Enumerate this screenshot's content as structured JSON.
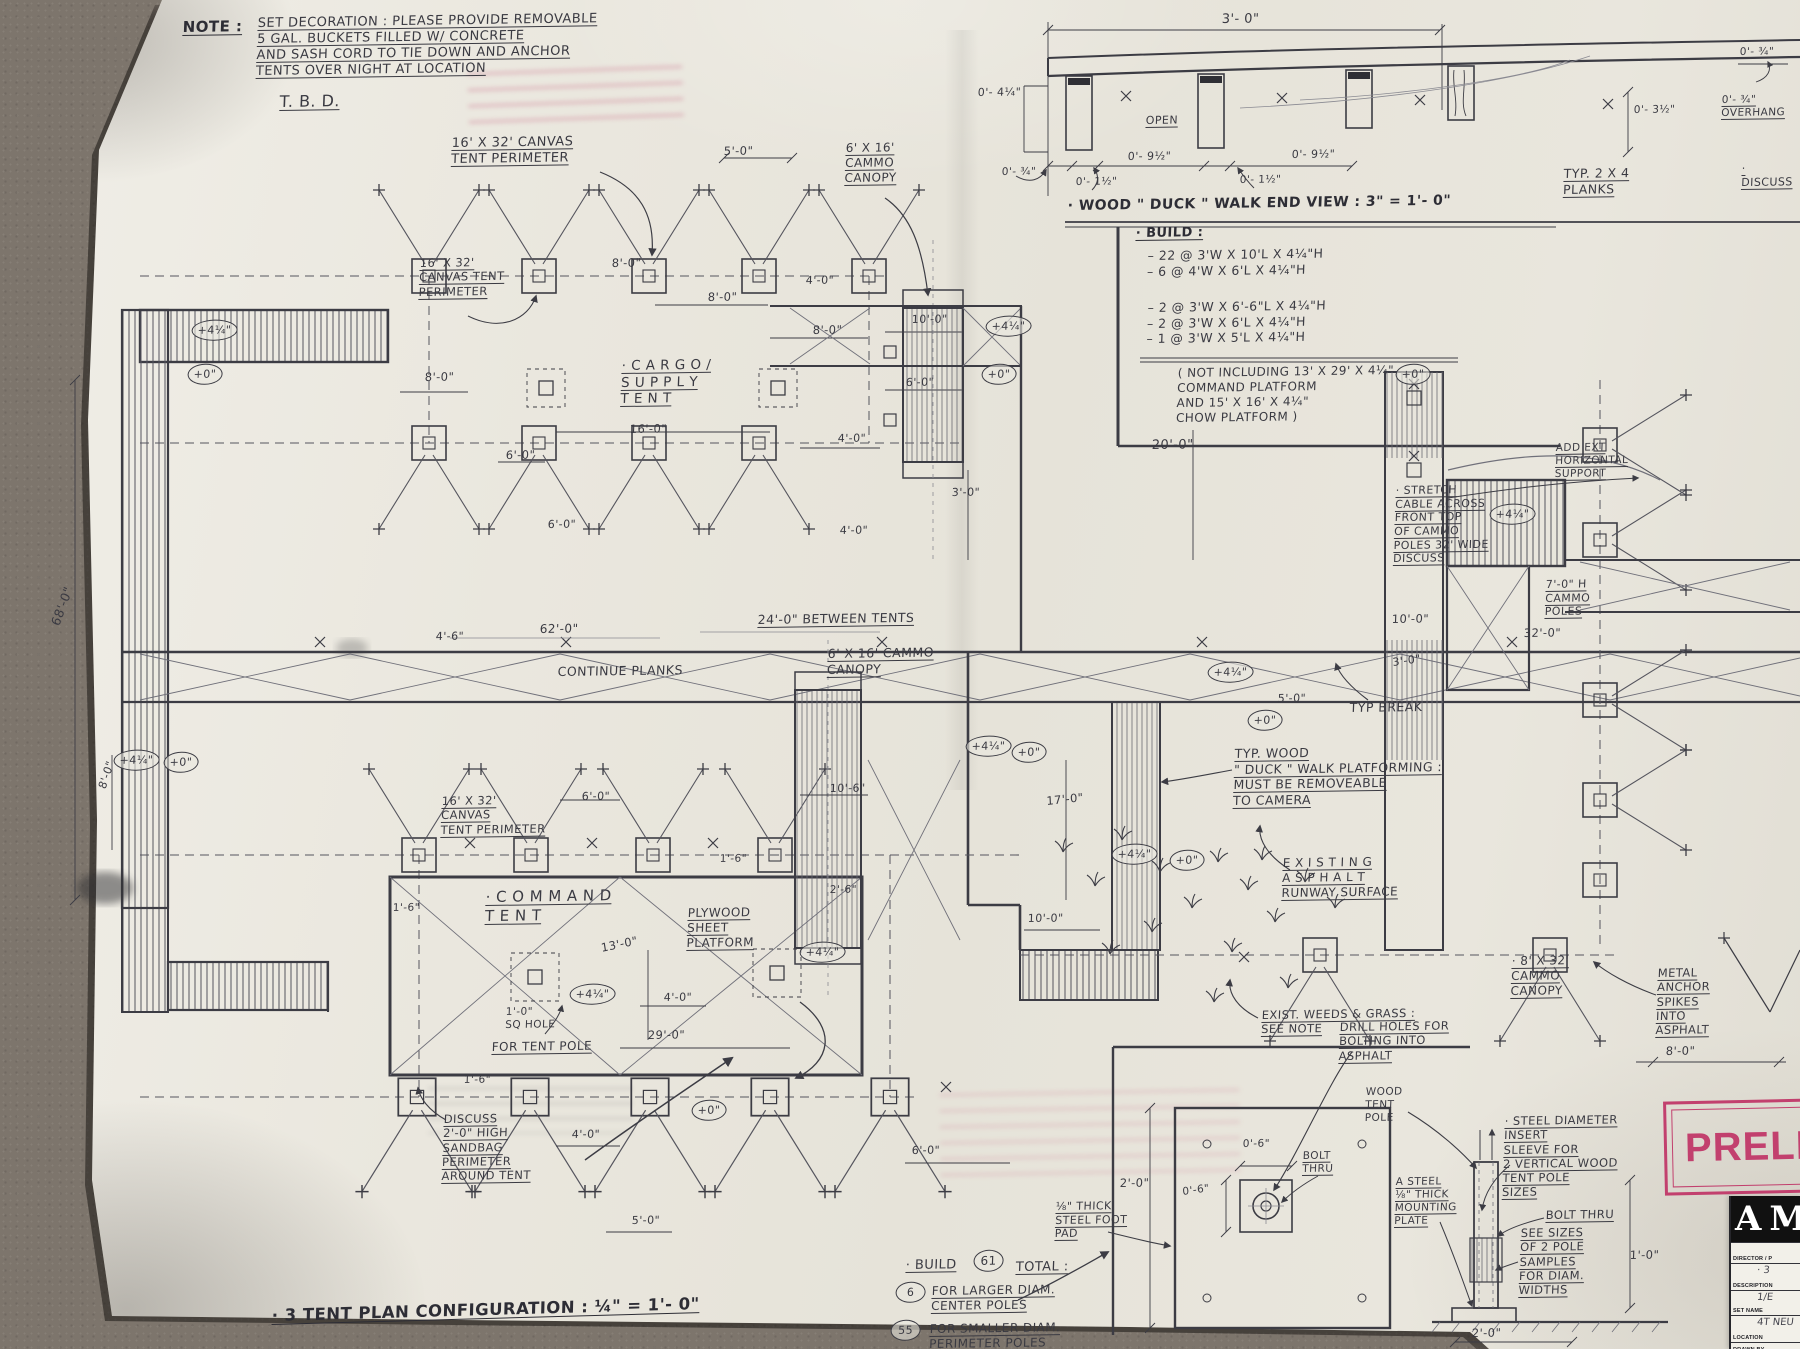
{
  "stamp": {
    "text": "PRELIM",
    "color": "#c2406e"
  },
  "title_block": {
    "logo": "AM",
    "rows": [
      {
        "label": "DIRECTOR / P",
        "value": ""
      },
      {
        "label": "DESCRIPTION",
        "value": "· 3"
      },
      {
        "label": "SET NAME",
        "value": "1/E"
      },
      {
        "label": "LOCATION",
        "value": "4T NEU"
      },
      {
        "label": "DRAWN BY",
        "value": ""
      }
    ]
  },
  "annotations": [
    {
      "n": "note-heading",
      "t": "NOTE :",
      "x": 183,
      "y": 18,
      "s": 15,
      "u": 1,
      "b": 1
    },
    {
      "n": "note-body",
      "t": "SET DECORATION : PLEASE PROVIDE REMOVABLE\n5 GAL. BUCKETS FILLED W/ CONCRETE\nAND SASH CORD TO TIE DOWN AND ANCHOR\nTENTS OVER NIGHT AT LOCATION",
      "x": 258,
      "y": 16,
      "s": 13,
      "u": 1,
      "w": 345
    },
    {
      "n": "note-tbd",
      "t": "T. B. D.",
      "x": 280,
      "y": 92,
      "s": 16,
      "u": 1
    },
    {
      "n": "label-tent-perimeter-upper",
      "t": "16' X 32' CANVAS\nTENT PERIMETER",
      "x": 452,
      "y": 136,
      "s": 13,
      "u": 1
    },
    {
      "n": "dim-5ft-upper",
      "t": "5'-0\"",
      "x": 724,
      "y": 144,
      "s": 11.5
    },
    {
      "n": "label-cammo-canopy-upper",
      "t": "6' X 16'\nCAMMO\nCANOPY",
      "x": 846,
      "y": 141,
      "s": 12,
      "u": 1
    },
    {
      "n": "label-tent-perimeter-note-upper",
      "t": "16' X 32'\nCANVAS TENT\nPERIMETER",
      "x": 420,
      "y": 256,
      "s": 11.5,
      "u": 1
    },
    {
      "n": "dim",
      "t": "8'-0\"",
      "x": 612,
      "y": 256,
      "s": 11.5
    },
    {
      "n": "dim",
      "t": "8'-0\"",
      "x": 708,
      "y": 290,
      "s": 11.5
    },
    {
      "n": "dim",
      "t": "4'-0\"",
      "x": 806,
      "y": 274,
      "s": 11
    },
    {
      "n": "dim",
      "t": "8'-0\"",
      "x": 813,
      "y": 323,
      "s": 11.5
    },
    {
      "n": "dim",
      "t": "10'-0\"",
      "x": 912,
      "y": 313,
      "s": 11
    },
    {
      "n": "dim",
      "t": "6'-0\"",
      "x": 906,
      "y": 376,
      "s": 11
    },
    {
      "n": "dim",
      "t": "4'-0\"",
      "x": 838,
      "y": 432,
      "s": 11
    },
    {
      "n": "label-cargo-tent",
      "t": "· C A R G O /\nS U P P L Y\nT E N T",
      "x": 622,
      "y": 358,
      "s": 13.5,
      "u": 1
    },
    {
      "n": "dim",
      "t": "16'-0\"",
      "x": 630,
      "y": 422,
      "s": 11.5
    },
    {
      "n": "dim",
      "t": "8'-0\"",
      "x": 425,
      "y": 370,
      "s": 11.5
    },
    {
      "n": "dim",
      "t": "6'-0\"",
      "x": 506,
      "y": 448,
      "s": 11.5
    },
    {
      "n": "dim",
      "t": "3'-0\"",
      "x": 952,
      "y": 486,
      "s": 11
    },
    {
      "n": "dim-20ft",
      "t": "20'-0\"",
      "x": 1152,
      "y": 438,
      "s": 13
    },
    {
      "n": "label-between-tents",
      "t": "24'-0\" BETWEEN TENTS",
      "x": 758,
      "y": 612,
      "s": 12.5,
      "u": 1
    },
    {
      "n": "label-continue-planks",
      "t": "CONTINUE  PLANKS",
      "x": 558,
      "y": 664,
      "s": 12.5
    },
    {
      "n": "dim",
      "t": "62'-0\"",
      "x": 540,
      "y": 622,
      "s": 12
    },
    {
      "n": "dim",
      "t": "4'-6\"",
      "x": 436,
      "y": 630,
      "s": 11
    },
    {
      "n": "dim-68ft",
      "t": "68'-0\"",
      "x": 48,
      "y": 622,
      "s": 12.5,
      "r": -70
    },
    {
      "n": "dim",
      "t": "6'-0\"",
      "x": 548,
      "y": 518,
      "s": 11
    },
    {
      "n": "dim",
      "t": "4'-0\"",
      "x": 840,
      "y": 524,
      "s": 11
    },
    {
      "n": "dim",
      "t": "8'-0\"",
      "x": 96,
      "y": 786,
      "s": 11,
      "r": -72
    },
    {
      "n": "label-stretch-cable",
      "t": "· STRETCH\nCABLE ACROSS\nFRONT TOP\nOF CAMMO\nPOLES 32' WIDE\nDISCUSS",
      "x": 1396,
      "y": 484,
      "s": 11,
      "u": 1,
      "w": 108
    },
    {
      "n": "label-cammo-poles",
      "t": "7'-0\" H\nCAMMO\nPOLES",
      "x": 1546,
      "y": 578,
      "s": 11,
      "u": 1
    },
    {
      "n": "dim",
      "t": "32'-0\"",
      "x": 1524,
      "y": 626,
      "s": 11.5
    },
    {
      "n": "dim",
      "t": "10'-0\"",
      "x": 1392,
      "y": 612,
      "s": 11.5
    },
    {
      "n": "dim",
      "t": "3'-0\"",
      "x": 1392,
      "y": 656,
      "s": 11,
      "r": -8
    },
    {
      "n": "label-typ-break",
      "t": "TYP  BREAK",
      "x": 1350,
      "y": 700,
      "s": 12.5
    },
    {
      "n": "label-duck-walk-typ",
      "t": "TYP. WOOD\n\" DUCK \" WALK  PLATFORMING :\nMUST  BE  REMOVEABLE\nTO CAMERA",
      "x": 1235,
      "y": 746,
      "s": 12.5,
      "u": 1,
      "w": 235
    },
    {
      "n": "dim",
      "t": "17'-0\"",
      "x": 1046,
      "y": 794,
      "s": 11.5,
      "r": -6
    },
    {
      "n": "label-existing-asphalt",
      "t": "E X I S T I N G\nA S P H A L T\nRUNWAY  SURFACE",
      "x": 1283,
      "y": 856,
      "s": 12,
      "u": 1
    },
    {
      "n": "label-exist-weeds",
      "t": "EXIST. WEEDS & GRASS :\nSEE  NOTE",
      "x": 1262,
      "y": 1008,
      "s": 11.5,
      "u": 1
    },
    {
      "n": "dim",
      "t": "10'-0\"",
      "x": 1028,
      "y": 912,
      "s": 11
    },
    {
      "n": "dim",
      "t": "5'-0\"",
      "x": 1278,
      "y": 692,
      "s": 11
    },
    {
      "n": "label-tent-perimeter-lower",
      "t": "16' X 32'\nCANVAS\nTENT PERIMETER",
      "x": 442,
      "y": 794,
      "s": 11.5,
      "u": 1
    },
    {
      "n": "dim",
      "t": "6'-0\"",
      "x": 582,
      "y": 790,
      "s": 11
    },
    {
      "n": "dim",
      "t": "10'-6\"",
      "x": 830,
      "y": 782,
      "s": 11
    },
    {
      "n": "dim",
      "t": "1'-6\"",
      "x": 720,
      "y": 853,
      "s": 10.5
    },
    {
      "n": "dim",
      "t": "2'-6\"",
      "x": 830,
      "y": 884,
      "s": 10.5
    },
    {
      "n": "dim",
      "t": "1'-6\"",
      "x": 393,
      "y": 902,
      "s": 10.5
    },
    {
      "n": "label-command-tent",
      "t": "· C O M M A N D\nT E N T",
      "x": 486,
      "y": 888,
      "s": 15,
      "u": 1
    },
    {
      "n": "label-plywood-platform",
      "t": "PLYWOOD\nSHEET\nPLATFORM",
      "x": 688,
      "y": 906,
      "s": 12,
      "u": 1
    },
    {
      "n": "dim",
      "t": "13'-0\"",
      "x": 600,
      "y": 941,
      "s": 11.5,
      "r": -12
    },
    {
      "n": "dim",
      "t": "4'-0\"",
      "x": 664,
      "y": 991,
      "s": 11
    },
    {
      "n": "label-sq-hole",
      "t": "1'-0\"\nSQ  HOLE",
      "x": 506,
      "y": 1006,
      "s": 10.5
    },
    {
      "n": "label-for-tent-pole",
      "t": "FOR  TENT POLE",
      "x": 492,
      "y": 1040,
      "s": 12,
      "u": 1
    },
    {
      "n": "dim",
      "t": "29'-0\"",
      "x": 648,
      "y": 1028,
      "s": 11.5
    },
    {
      "n": "dim",
      "t": "1'-6\"",
      "x": 464,
      "y": 1074,
      "s": 10.5
    },
    {
      "n": "label-sandbag",
      "t": "DISCUSS\n2'-0\" HIGH\nSANDBAG\nPERIMETER\nAROUND TENT",
      "x": 444,
      "y": 1112,
      "s": 11.5,
      "u": 1
    },
    {
      "n": "dim",
      "t": "4'-0\"",
      "x": 572,
      "y": 1128,
      "s": 11
    },
    {
      "n": "dim",
      "t": "5'-0\"",
      "x": 632,
      "y": 1214,
      "s": 11
    },
    {
      "n": "sheet-title",
      "t": "· 3  TENT  PLAN  CONFIGURATION :  ¼\" = 1'- 0\"",
      "x": 272,
      "y": 1306,
      "s": 16.5,
      "u": 1,
      "r": -1.6,
      "b": 1
    },
    {
      "n": "label-build-total",
      "t": "· BUILD",
      "x": 906,
      "y": 1258,
      "s": 13,
      "u": 1
    },
    {
      "n": "circ-61",
      "t": "61",
      "x": 974,
      "y": 1250,
      "c": 1,
      "s": 12
    },
    {
      "n": "label-total",
      "t": "TOTAL :",
      "x": 1016,
      "y": 1260,
      "s": 13,
      "u": 1
    },
    {
      "n": "circ-6",
      "t": "6",
      "x": 896,
      "y": 1282,
      "c": 1,
      "s": 11
    },
    {
      "n": "label-center-poles",
      "t": "FOR LARGER DIAM.\nCENTER  POLES",
      "x": 932,
      "y": 1284,
      "s": 12,
      "u": 1
    },
    {
      "n": "circ-55",
      "t": "55",
      "x": 891,
      "y": 1320,
      "c": 1,
      "s": 11
    },
    {
      "n": "label-perimeter-poles",
      "t": "FOR SMALLER DIAM.\nPERIMETER POLES",
      "x": 930,
      "y": 1322,
      "s": 12,
      "u": 1
    },
    {
      "n": "dim",
      "t": "6'-0\"",
      "x": 912,
      "y": 1144,
      "s": 11
    },
    {
      "n": "dim",
      "t": "2'-0\"",
      "x": 1120,
      "y": 1176,
      "s": 11.5
    },
    {
      "n": "label-drill-holes",
      "t": "DRILL HOLES FOR\nBOLTING INTO\nASPHALT",
      "x": 1340,
      "y": 1020,
      "s": 11.5,
      "u": 1
    },
    {
      "n": "label-wood-tent-pole",
      "t": "WOOD\nTENT\nPOLE",
      "x": 1366,
      "y": 1086,
      "s": 10.5
    },
    {
      "n": "label-mounting-plate",
      "t": "A STEEL\n⅛\" THICK\nMOUNTING\nPLATE",
      "x": 1396,
      "y": 1176,
      "s": 10.5,
      "u": 1
    },
    {
      "n": "label-steel-foot-pad",
      "t": "⅛\" THICK\nSTEEL FOOT\nPAD",
      "x": 1056,
      "y": 1200,
      "s": 11,
      "u": 1
    },
    {
      "n": "dim",
      "t": "0'-6\"",
      "x": 1243,
      "y": 1138,
      "s": 10.5
    },
    {
      "n": "dim",
      "t": "0'-6\"",
      "x": 1182,
      "y": 1186,
      "s": 10.5,
      "r": -8
    },
    {
      "n": "label-bolt-thru-pad",
      "t": "BOLT\nTHRU",
      "x": 1303,
      "y": 1150,
      "s": 10.5,
      "u": 1
    },
    {
      "n": "label-insert-sleeve",
      "t": "· STEEL  DIAMETER\nINSERT\nSLEEVE  FOR\n2 VERTICAL WOOD\nTENT  POLE\nSIZES",
      "x": 1505,
      "y": 1114,
      "s": 11.5,
      "u": 1,
      "w": 165
    },
    {
      "n": "label-bolt-thru-pole",
      "t": "BOLT  THRU",
      "x": 1546,
      "y": 1208,
      "s": 11.5,
      "u": 1
    },
    {
      "n": "label-pole-samples",
      "t": "SEE SIZES\nOF 2 POLE\nSAMPLES\nFOR DIAM.\nWIDTHS",
      "x": 1521,
      "y": 1226,
      "s": 11.5,
      "u": 1
    },
    {
      "n": "dim",
      "t": "1'-0\"",
      "x": 1630,
      "y": 1248,
      "s": 11.5
    },
    {
      "n": "dim",
      "t": "2'-0\"",
      "x": 1472,
      "y": 1326,
      "s": 11.5
    },
    {
      "n": "label-cammo-canopy-832",
      "t": "· 8' X 32'\nCAMMO\nCANOPY",
      "x": 1512,
      "y": 954,
      "s": 12,
      "u": 1
    },
    {
      "n": "label-metal-spikes",
      "t": "METAL\nANCHOR\nSPIKES\nINTO\nASPHALT",
      "x": 1658,
      "y": 966,
      "s": 11.5,
      "u": 1
    },
    {
      "n": "dim",
      "t": "8'-0\"",
      "x": 1666,
      "y": 1044,
      "s": 11.5
    },
    {
      "n": "label-add-support",
      "t": "ADD EXT\nHORIZONTAL\nSUPPORT",
      "x": 1556,
      "y": 442,
      "s": 10.5,
      "u": 1
    },
    {
      "n": "label-cammo-canopy-lower",
      "t": "6' X 16' CAMMO\nCANOPY",
      "x": 828,
      "y": 646,
      "s": 12.5,
      "u": 1
    },
    {
      "n": "label-duckwalk-title",
      "t": "· WOOD \" DUCK \" WALK  END VIEW :  3\" = 1'- 0\"",
      "x": 1068,
      "y": 198,
      "s": 14,
      "b": 1
    },
    {
      "n": "label-build-list-head",
      "t": "· BUILD :",
      "x": 1136,
      "y": 226,
      "s": 13,
      "u": 1,
      "b": 1
    },
    {
      "n": "label-build-list-1",
      "t": "–  22 @ 3'W X 10'L X 4¼\"H\n–  6 @ 4'W X 6'L X 4¼\"H",
      "x": 1148,
      "y": 248,
      "s": 12.5,
      "w": 290
    },
    {
      "n": "label-build-list-2",
      "t": "–  2 @ 3'W X 6'-6\"L X 4¼\"H\n–  2 @ 3'W X 6'L X 4¼\"H\n–  1 @ 3'W X 5'L X 4¼\"H",
      "x": 1148,
      "y": 300,
      "s": 12.5,
      "w": 300
    },
    {
      "n": "label-build-list-note",
      "t": "( NOT INCLUDING 13' X 29' X 4¼\"\nCOMMAND  PLATFORM\nAND 15' X 16' X 4¼\"\nCHOW PLATFORM )",
      "x": 1178,
      "y": 366,
      "s": 12,
      "w": 300
    },
    {
      "n": "dim",
      "t": "3'- 0\"",
      "x": 1222,
      "y": 12,
      "s": 13
    },
    {
      "n": "dim",
      "t": "0'- 4¼\"",
      "x": 978,
      "y": 86,
      "s": 11
    },
    {
      "n": "label-open",
      "t": "OPEN",
      "x": 1146,
      "y": 114,
      "s": 11,
      "u": 1
    },
    {
      "n": "dim",
      "t": "0'- ¾\"",
      "x": 1002,
      "y": 166,
      "s": 10.5
    },
    {
      "n": "dim",
      "t": "0'- 1½\"",
      "x": 1076,
      "y": 176,
      "s": 10.5
    },
    {
      "n": "dim",
      "t": "0'- 9½\"",
      "x": 1128,
      "y": 150,
      "s": 11
    },
    {
      "n": "dim",
      "t": "0'- 1½\"",
      "x": 1240,
      "y": 174,
      "s": 10.5
    },
    {
      "n": "dim",
      "t": "0'- 9½\"",
      "x": 1292,
      "y": 148,
      "s": 11
    },
    {
      "n": "label-typ-planks",
      "t": "TYP.  2 X 4\nPLANKS",
      "x": 1564,
      "y": 166,
      "s": 12.5,
      "u": 1
    },
    {
      "n": "dim",
      "t": "0'- 3½\"",
      "x": 1634,
      "y": 104,
      "s": 10.5
    },
    {
      "n": "dim",
      "t": "0'- ¾\"",
      "x": 1740,
      "y": 46,
      "s": 10.5
    },
    {
      "n": "label-overhang",
      "t": "0'- ¾\"\nOVERHANG",
      "x": 1722,
      "y": 94,
      "s": 10.5,
      "u": 1
    },
    {
      "n": "label-discuss-right",
      "t": "· DISCUSS",
      "x": 1742,
      "y": 162,
      "s": 11,
      "u": 1
    },
    {
      "n": "level-marker",
      "t": "+4¼\"",
      "x": 192,
      "y": 320,
      "c": 1
    },
    {
      "n": "level-marker",
      "t": "+0\"",
      "x": 188,
      "y": 364,
      "c": 1
    },
    {
      "n": "level-marker",
      "t": "+4¼\"",
      "x": 986,
      "y": 316,
      "c": 1
    },
    {
      "n": "level-marker",
      "t": "+0\"",
      "x": 982,
      "y": 364,
      "c": 1
    },
    {
      "n": "level-marker",
      "t": "+4¼\"",
      "x": 1208,
      "y": 662,
      "c": 1
    },
    {
      "n": "level-marker",
      "t": "+0\"",
      "x": 1248,
      "y": 710,
      "c": 1
    },
    {
      "n": "level-marker",
      "t": "+4¼\"",
      "x": 1112,
      "y": 844,
      "c": 1
    },
    {
      "n": "level-marker",
      "t": "+0\"",
      "x": 1170,
      "y": 850,
      "c": 1
    },
    {
      "n": "level-marker",
      "t": "+4¼\"",
      "x": 114,
      "y": 750,
      "c": 1
    },
    {
      "n": "level-marker",
      "t": "+0\"",
      "x": 164,
      "y": 752,
      "c": 1
    },
    {
      "n": "level-marker",
      "t": "+4¼\"",
      "x": 570,
      "y": 984,
      "c": 1
    },
    {
      "n": "level-marker",
      "t": "+0\"",
      "x": 692,
      "y": 1100,
      "c": 1
    },
    {
      "n": "level-marker",
      "t": "+4¼\"",
      "x": 800,
      "y": 942,
      "c": 1
    },
    {
      "n": "level-marker",
      "t": "+4¼\"",
      "x": 966,
      "y": 736,
      "c": 1
    },
    {
      "n": "level-marker",
      "t": "+0\"",
      "x": 1012,
      "y": 742,
      "c": 1
    },
    {
      "n": "level-marker",
      "t": "+4¼\"",
      "x": 1490,
      "y": 504,
      "c": 1
    },
    {
      "n": "level-marker",
      "t": "+0\"",
      "x": 1396,
      "y": 364,
      "c": 1
    }
  ]
}
